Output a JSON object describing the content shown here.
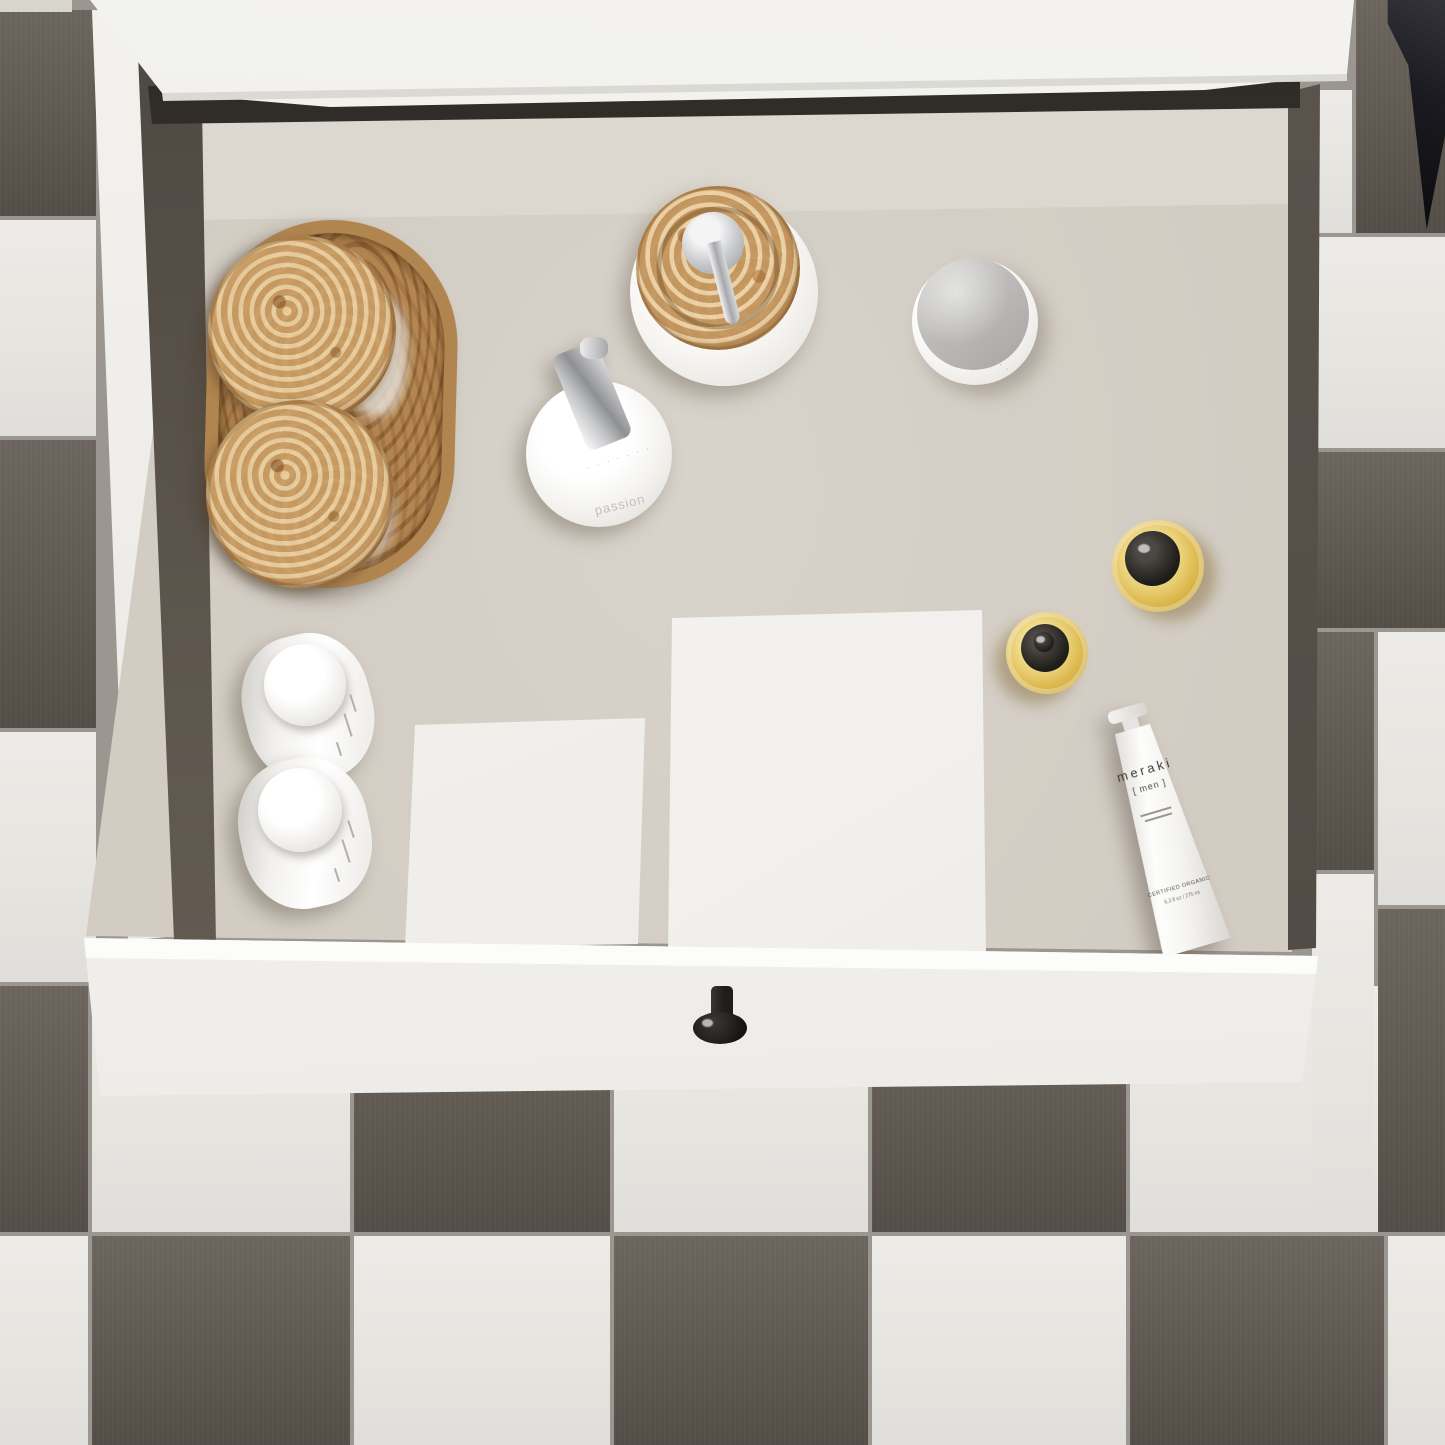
{
  "meta": {
    "title": "Open bathroom vanity drawer with toiletries — top-down view",
    "setting": "checkerboard tiled bathroom floor"
  },
  "palette": {
    "floor_tile_dark": "#5f5952",
    "floor_tile_light": "#eae8e3",
    "grout": "#9b968f",
    "countertop_white": "#f2f1ee",
    "drawer_interior": "#d2ccc3",
    "drawer_wall_dark": "#57504a",
    "drawer_front_white": "#f4f3f0",
    "knob_black": "#242020",
    "burl_wood": "#c59a5f",
    "amber_oil": "#ddba50",
    "chrome": "#b9babd"
  },
  "tube": {
    "brand": "meraki",
    "range": "[ men ]",
    "certification": "CERTIFIED ORGANIC",
    "volume": "6.3 fl oz / 275 ml"
  },
  "pump_bottle": {
    "label": "passion",
    "dots": "· · · · · · ·"
  },
  "jar": {
    "dots": "· · · ·"
  }
}
